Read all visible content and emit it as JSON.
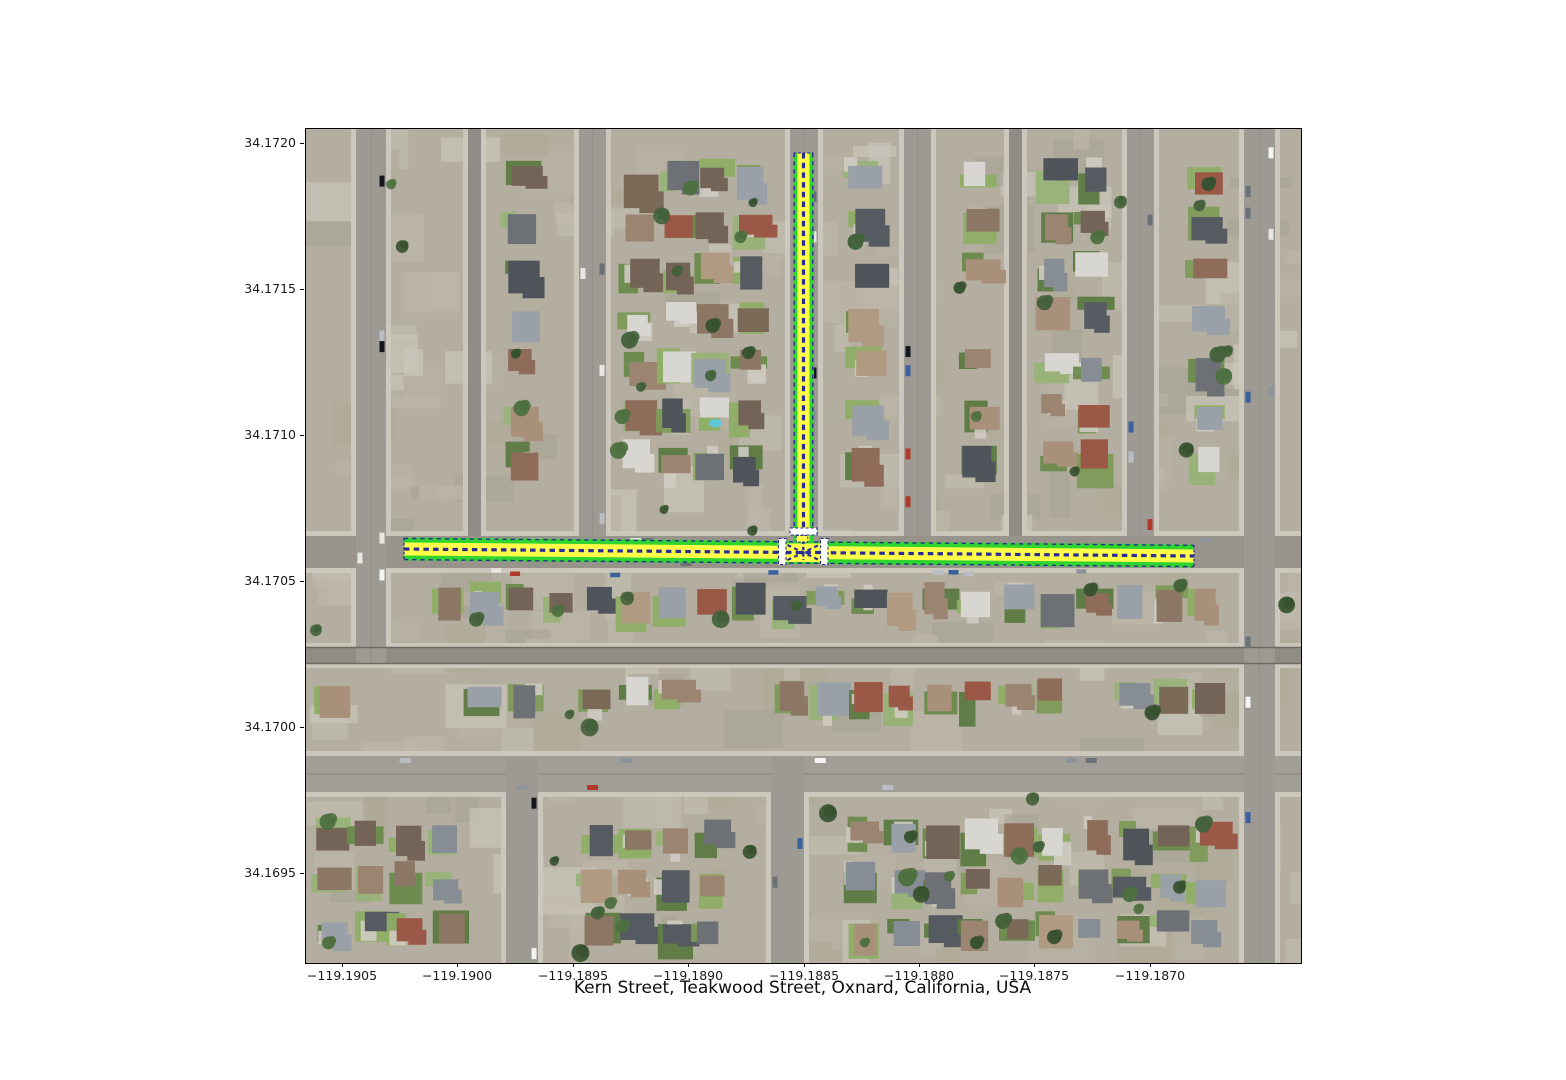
{
  "figure": {
    "xlabel": "Kern Street, Teakwood Street, Oxnard, California, USA",
    "background_color": "#ffffff"
  },
  "axes": {
    "x_tick_labels": [
      "−119.1905",
      "−119.1900",
      "−119.1895",
      "−119.1890",
      "−119.1885",
      "−119.1880",
      "−119.1875",
      "−119.1870"
    ],
    "y_tick_labels": [
      "34.1720",
      "34.1715",
      "34.1710",
      "34.1705",
      "34.1700",
      "34.1695"
    ]
  },
  "map": {
    "highlight": {
      "route_edge_green": "#2fd42f",
      "route_fill_yellow": "#ffff4a",
      "lane_marking_blue": "#2b2b96",
      "crosswalk_white": "#ffffff"
    },
    "imagery": {
      "street_gray": "#98948c",
      "sidewalk": "#ccc8be",
      "ground_tan": "#b3ae9f",
      "lawn_green": "#7d9a58",
      "tree_green": "#42603a"
    }
  }
}
